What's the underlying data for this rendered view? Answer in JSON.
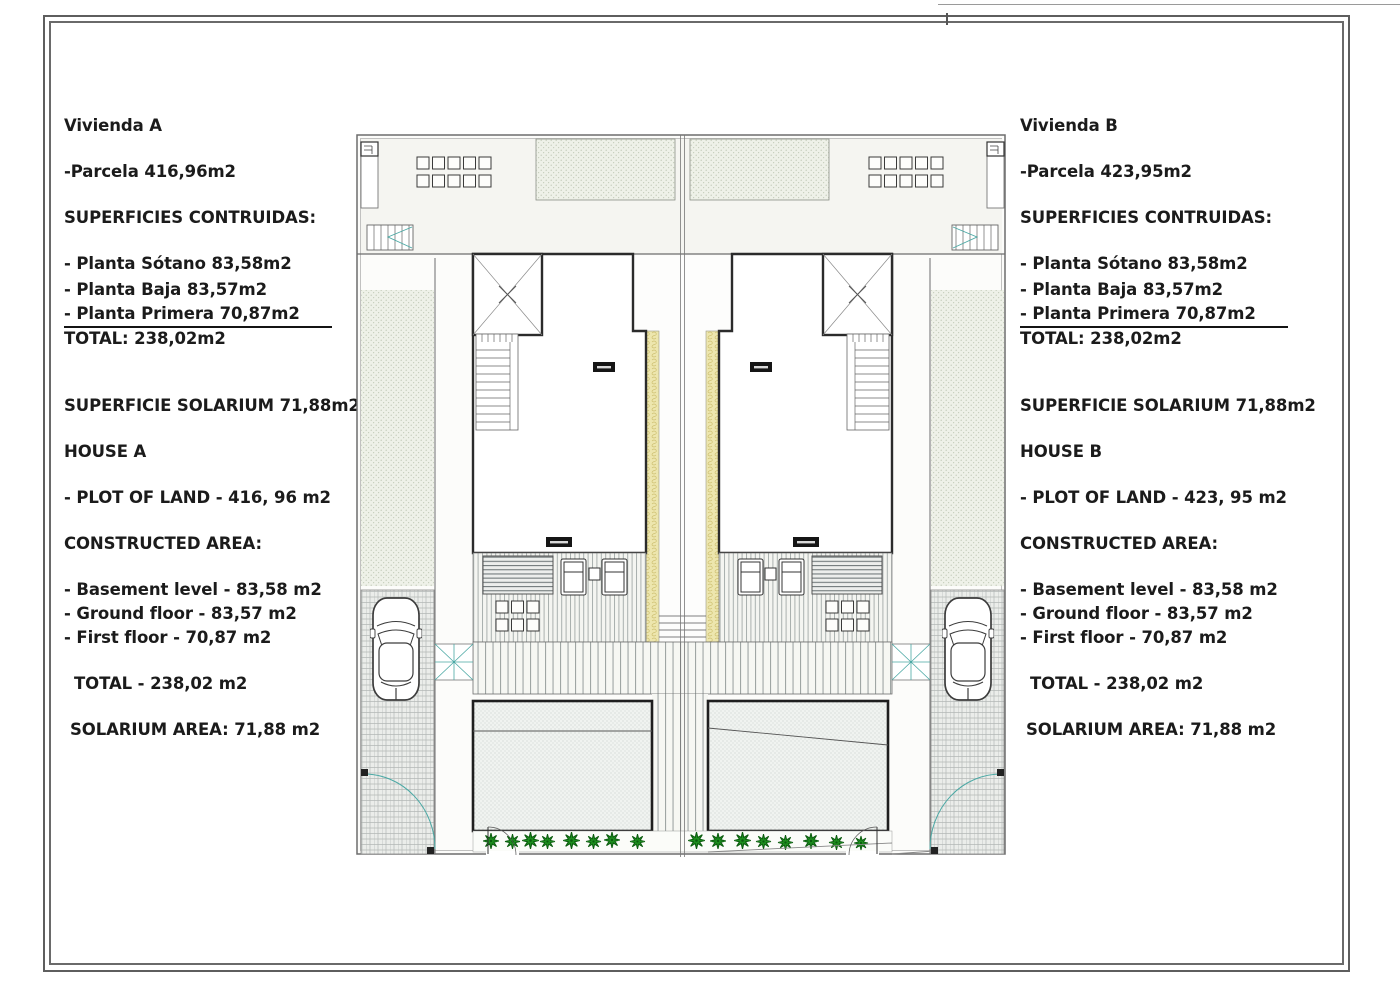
{
  "panels": {
    "left": {
      "title": "Vivienda A",
      "parcela": "-Parcela 416,96m2",
      "superficies_heading": "SUPERFICIES CONTRUIDAS:",
      "plantas": [
        "- Planta Sótano 83,58m2",
        "- Planta Baja 83,57m2",
        "- Planta Primera 70,87m2"
      ],
      "total": "TOTAL: 238,02m2",
      "solarium": "SUPERFICIE SOLARIUM 71,88m2",
      "house_heading": "HOUSE A",
      "plot_of_land": "- PLOT OF LAND - 416, 96 m2",
      "constructed_heading": "CONSTRUCTED AREA:",
      "floors": [
        "- Basement level - 83,58 m2",
        "- Ground floor - 83,57 m2",
        "- First floor - 70,87 m2"
      ],
      "total_en": "TOTAL - 238,02 m2",
      "solarium_en": "SOLARIUM AREA: 71,88 m2"
    },
    "right": {
      "title": "Vivienda B",
      "parcela": "-Parcela 423,95m2",
      "superficies_heading": "SUPERFICIES CONTRUIDAS:",
      "plantas": [
        "- Planta Sótano 83,58m2",
        "- Planta Baja 83,57m2",
        "- Planta Primera 70,87m2"
      ],
      "total": "TOTAL: 238,02m2",
      "solarium": "SUPERFICIE SOLARIUM 71,88m2",
      "house_heading": "HOUSE B",
      "plot_of_land": "- PLOT OF LAND - 423, 95 m2",
      "constructed_heading": "CONSTRUCTED AREA:",
      "floors": [
        "- Basement level - 83,58 m2",
        "- Ground floor - 83,57 m2",
        "- First floor - 70,87 m2"
      ],
      "total_en": "TOTAL - 238,02 m2",
      "solarium_en": "SOLARIUM AREA: 71,88 m2"
    }
  },
  "plan": {
    "colors": {
      "bold_wall": "#2b2b2b",
      "thin_line": "#5a5f5e",
      "party_wall_yellow": "#ece5ab",
      "accent_teal": "#4aa8a4",
      "plant_green": "#1d8f1e",
      "hatch_background": "#eef1e8",
      "deck_background": "#f4f5f1"
    }
  }
}
